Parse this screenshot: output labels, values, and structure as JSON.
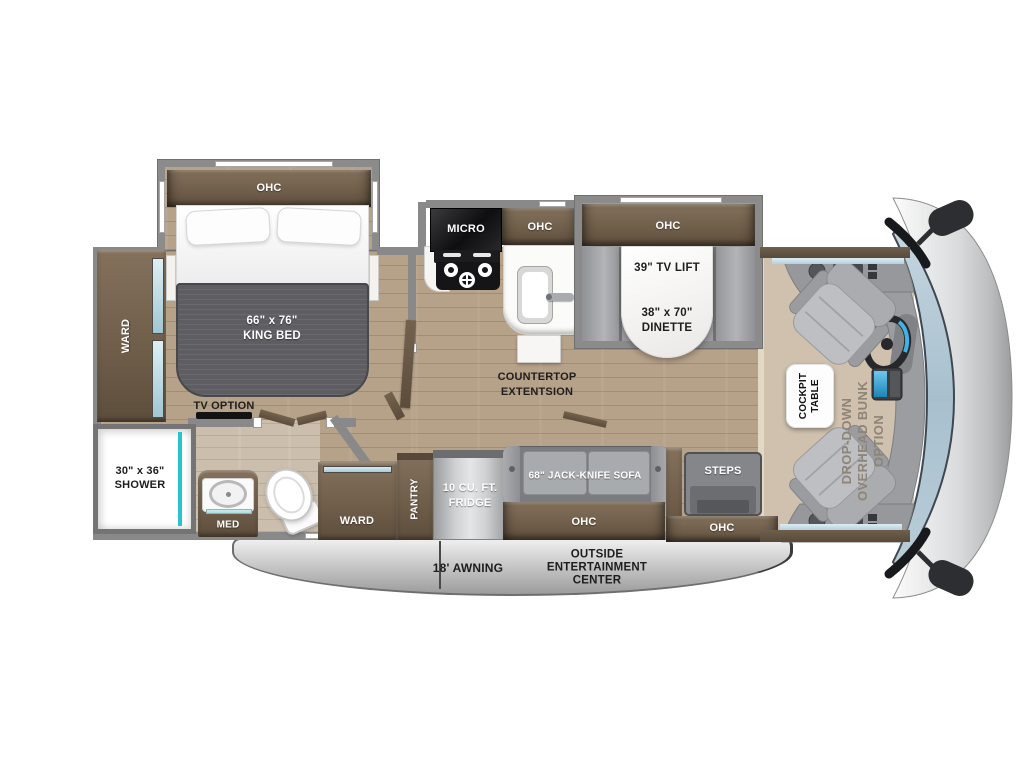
{
  "fp": {
    "bedroom": {
      "ohc": "OHC",
      "ward": "WARD",
      "bed_size": "66\" x 76\"",
      "bed_name": "KING BED",
      "tv_option": "TV OPTION"
    },
    "bath": {
      "shower_size": "30\" x 36\"",
      "shower_name": "SHOWER",
      "med": "MED"
    },
    "galley": {
      "micro": "MICRO",
      "ohc": "OHC",
      "counter1": "COUNTERTOP",
      "counter2": "EXTENTSION"
    },
    "dinette": {
      "ohc": "OHC",
      "tv_lift": "39\" TV LIFT",
      "size": "38\" x 70\"",
      "name": "DINETTE"
    },
    "living": {
      "ward": "WARD",
      "pantry": "PANTRY",
      "fridge1": "10 CU. FT.",
      "fridge2": "FRIDGE",
      "sofa": "68\" JACK-KNIFE SOFA",
      "sofa_ohc": "OHC"
    },
    "entry": {
      "steps": "STEPS",
      "ohc": "OHC"
    },
    "cockpit": {
      "table1": "COCKPIT",
      "table2": "TABLE",
      "bunk1": "DROP-DOWN",
      "bunk2": "OVERHEAD BUNK",
      "bunk3": "OPTION"
    },
    "exterior": {
      "awning": "18' AWNING",
      "out1": "OUTSIDE",
      "out2": "ENTERTAINMENT",
      "out3": "CENTER"
    },
    "colors": {
      "cabinet_brown": "#6e5d49",
      "floor_wood": "#b6a189",
      "carpet_tan": "#cfc1ad",
      "wall_gray": "#898989",
      "windshield_blue": "#aec5d3",
      "shower_accent_teal": "#2ac3cb",
      "mattress_gray": "#5d5d62",
      "awning_gray": "#bdbdbd"
    }
  }
}
